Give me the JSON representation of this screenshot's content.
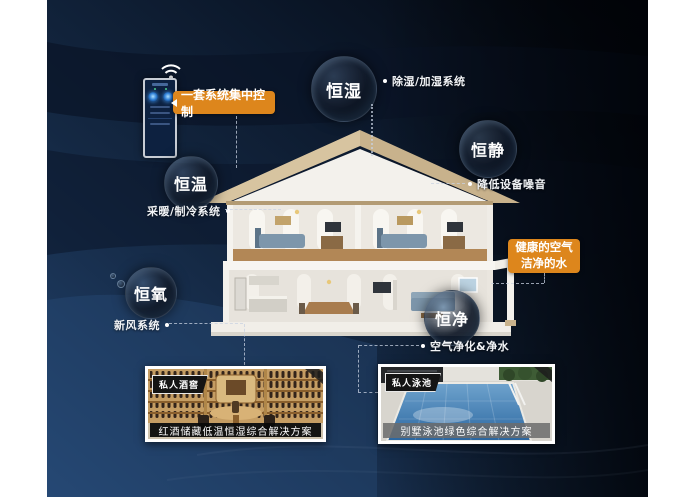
{
  "colors": {
    "accent_orange": "#dd861c",
    "background_light_navy": "#21406b",
    "background_deep_navy": "#0a1527",
    "bubble_text": "#ffffff"
  },
  "control_panel": {
    "label": "一套系统集中控制"
  },
  "bubbles": [
    {
      "label": "恒湿",
      "desc": "除湿/加湿系统"
    },
    {
      "label": "恒静",
      "desc": "降低设备噪音"
    },
    {
      "label": "恒温",
      "desc": "采暖/制冷系统"
    },
    {
      "label": "恒氧",
      "desc": "新风系统"
    },
    {
      "label": "恒净",
      "desc": "空气净化&净水"
    }
  ],
  "highlight": {
    "line1": "健康的空气",
    "line2": "洁净的水"
  },
  "cards": [
    {
      "tag": "私人酒窖",
      "caption": "红酒储藏低温恒湿综合解决方案"
    },
    {
      "tag": "私人泳池",
      "caption": "别墅泳池绿色综合解决方案"
    }
  ]
}
